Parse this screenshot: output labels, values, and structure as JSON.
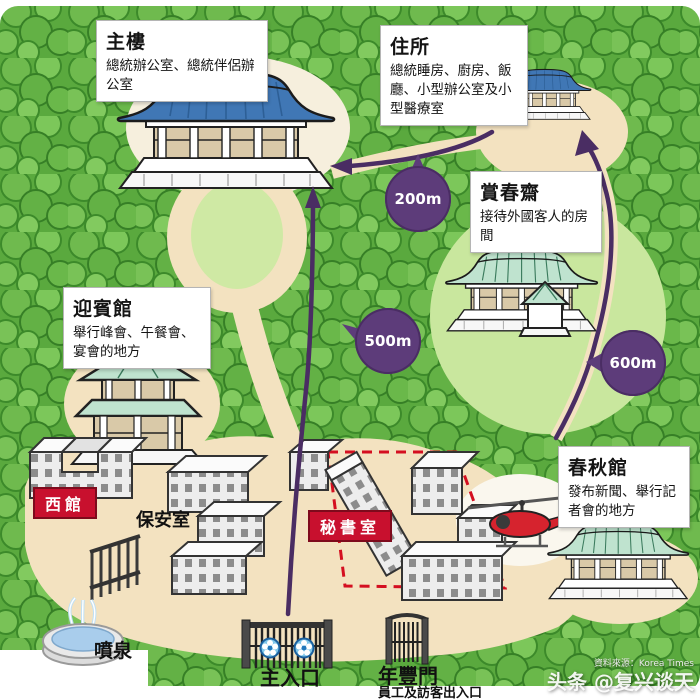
{
  "map": {
    "annotations": {
      "main_building": {
        "title": "主樓",
        "desc": "總統辦公室、總統伴侶辦公室"
      },
      "residence": {
        "title": "住所",
        "desc": "總統睡房、廚房、飯廳、小型辦公室及小型醫療室"
      },
      "sangchunjae": {
        "title": "賞春齋",
        "desc": "接待外國客人的房間"
      },
      "guest_house": {
        "title": "迎賓館",
        "desc": "舉行峰會、午餐會、宴會的地方"
      },
      "chunchugwan": {
        "title": "春秋館",
        "desc": "發布新聞、舉行記者會的地方"
      },
      "west_hall": {
        "title": "西館"
      },
      "security_office": {
        "title": "保安室"
      },
      "secretary_office": {
        "title": "秘書室"
      },
      "fountain": {
        "title": "噴泉"
      },
      "main_entrance": {
        "title": "主入口"
      },
      "yeonpung_gate": {
        "title": "年豐門",
        "desc": "員工及訪客出入口"
      }
    },
    "distance_markers": {
      "d200": "200m",
      "d500": "500m",
      "d600": "600m"
    },
    "watermark": {
      "source": "資料來源：Korea Times",
      "brand": "头条 @复兴谈天"
    },
    "colors": {
      "route": "#4a2d63",
      "marker": "#5d3c7a",
      "red_label": "#c8102e",
      "forest": "#5aa93e",
      "path": "#f3e2c0",
      "lawn": "#c9e79e",
      "roof_blue": "#4077b5",
      "roof_green": "#bfe3cf",
      "helicopter_red": "#d6232e"
    }
  }
}
